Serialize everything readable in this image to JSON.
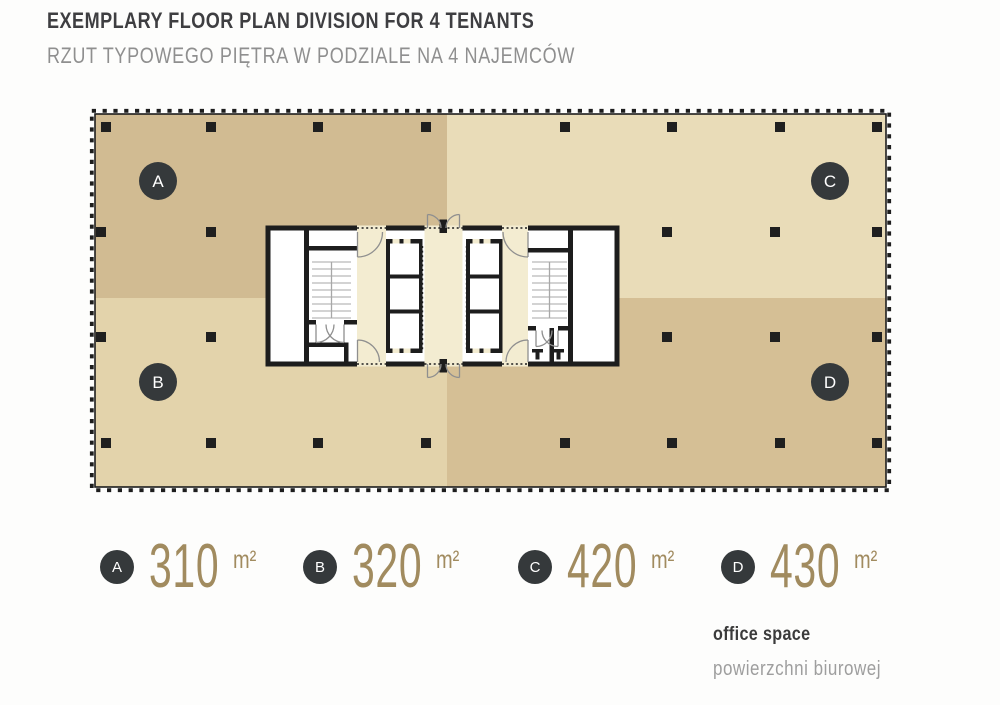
{
  "header": {
    "title": "EXEMPLARY FLOOR PLAN DIVISION FOR 4 TENANTS",
    "subtitle": "RZUT TYPOWEGO PIĘTRA W PODZIALE NA 4 NAJEMCÓW"
  },
  "tenants": [
    {
      "id": "A",
      "area": "310",
      "unit": "m²",
      "color": "#d1bb92"
    },
    {
      "id": "B",
      "area": "320",
      "unit": "m²",
      "color": "#e3d3ab"
    },
    {
      "id": "C",
      "area": "420",
      "unit": "m²",
      "color": "#e9dcb8"
    },
    {
      "id": "D",
      "area": "430",
      "unit": "m²",
      "color": "#d5bf95"
    }
  ],
  "legend_note": {
    "en": "office space",
    "pl": "powierzchni biurowej"
  },
  "plan": {
    "badge_color": "#35393b",
    "wall_color": "#1d1d1d",
    "corridor_color": "#f3ecd1",
    "column_color": "#1f1f1f"
  }
}
